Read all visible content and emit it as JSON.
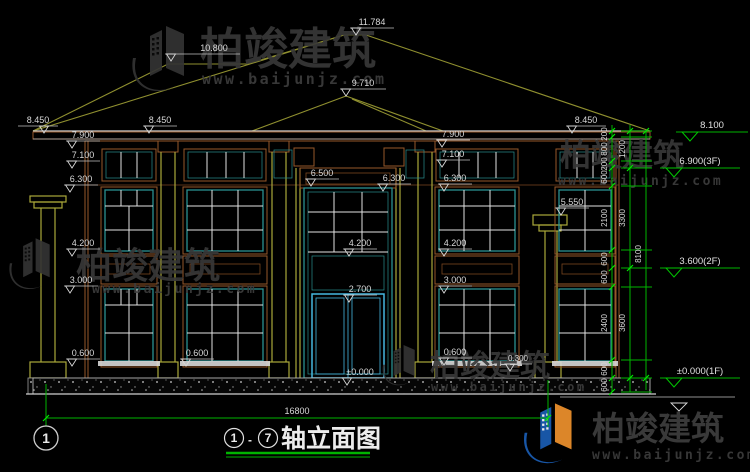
{
  "drawing_title": {
    "axis_start": "1",
    "separator": "-",
    "axis_end": "7",
    "name": "轴立面图"
  },
  "axis_bubbles": {
    "left": "1"
  },
  "elevations": {
    "e11784": "11.784",
    "e10800": "10.800",
    "e9710": "9.710",
    "e8450": "8.450",
    "e7900": "7.900",
    "e7100": "7.100",
    "e6500": "6.500",
    "e6300": "6.300",
    "e5550": "5.550",
    "e4200": "4.200",
    "e3000": "3.000",
    "e2700": "2.700",
    "e0600": "0.600",
    "e0300": "0.300",
    "e0000": "±0.000"
  },
  "floor_levels": {
    "top": "8.100",
    "f3": "6.900(3F)",
    "f2": "3.600(2F)",
    "f1": "±0.000(1F)"
  },
  "dims": {
    "d200": "200",
    "d800": "800",
    "d600": "600",
    "d1200": "1200",
    "d2100": "2100",
    "d2400": "2400",
    "d3300": "3300",
    "d3600": "3600",
    "d8100": "8100",
    "total_width": "16800"
  },
  "watermark": {
    "brand": "柏竣建筑",
    "url": "www.baijunjz.com"
  },
  "colors": {
    "background": "#000000",
    "dimension_green": "#00b400",
    "tick_green": "#00e800",
    "annotation_white": "#d8d8d8",
    "roof_olive": "#8f8f2f",
    "trim_brown": "#96582a",
    "frame_teal": "#2a9090",
    "door_cyan": "#45b7e0",
    "pilaster_yellow": "#aaa83a",
    "watermark_gray": "#3a3a3a",
    "logo_blue": "#1b5eb5",
    "logo_orange": "#f0922d"
  }
}
